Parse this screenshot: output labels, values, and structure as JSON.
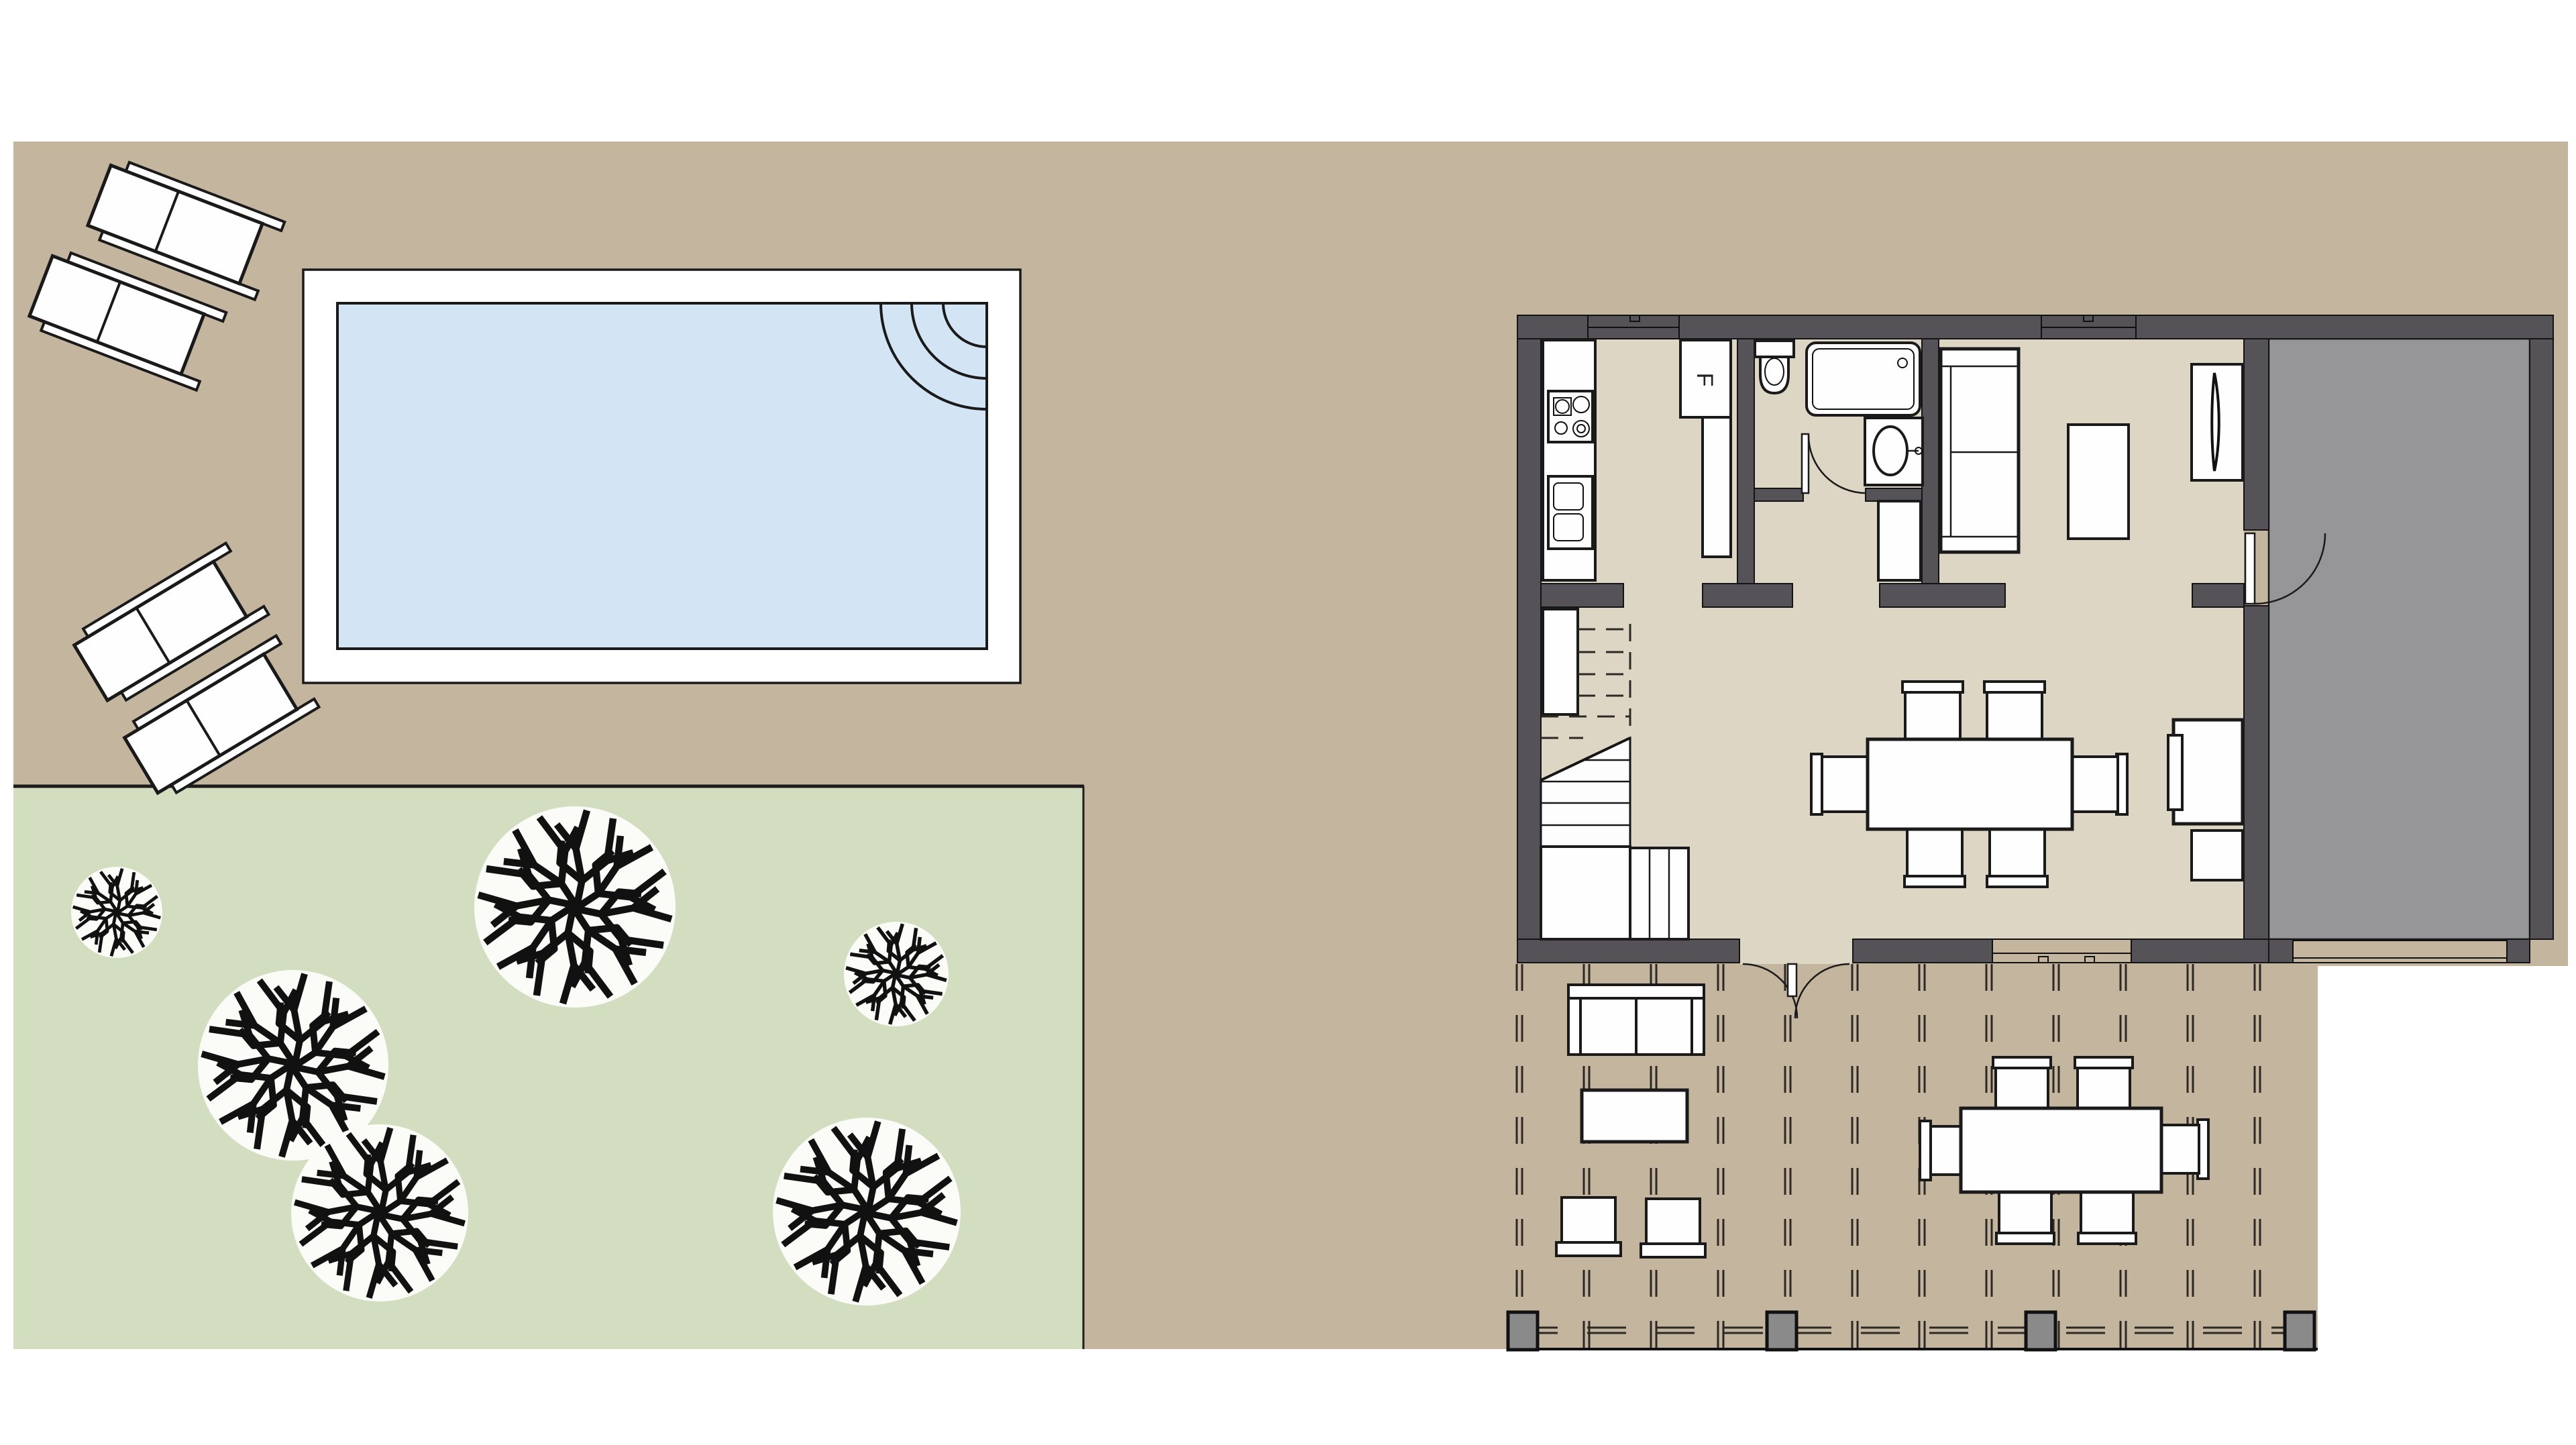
{
  "title": "site-and-floor-plan",
  "labels": {
    "fridge": "F"
  },
  "colors": {
    "page_bg": "#ffffff",
    "site": "#c4b59f",
    "lawn": "#d3dec1",
    "pool_deck": "#ffffff",
    "pool_water": "#d3e5f4",
    "wall": "#555258",
    "floor": "#ded6c4",
    "garage_floor": "#969698",
    "tree_canopy": "#fbfbf8",
    "post": "#8a8a8a",
    "window_white": "#ffffff",
    "furniture_white": "#fefefe",
    "line": "#1a1a1a"
  },
  "objects": {
    "pool": "swimming-pool",
    "pool_steps": "corner-steps-arcs",
    "loungers": "sun-lounger x4",
    "trees": "canopy-tree x6",
    "rooms": "kitchen, bathroom, hall, bedroom-living, main-living-dining, garage",
    "patio": "deck with pergola dashes, sofa set, dining set, posts"
  }
}
